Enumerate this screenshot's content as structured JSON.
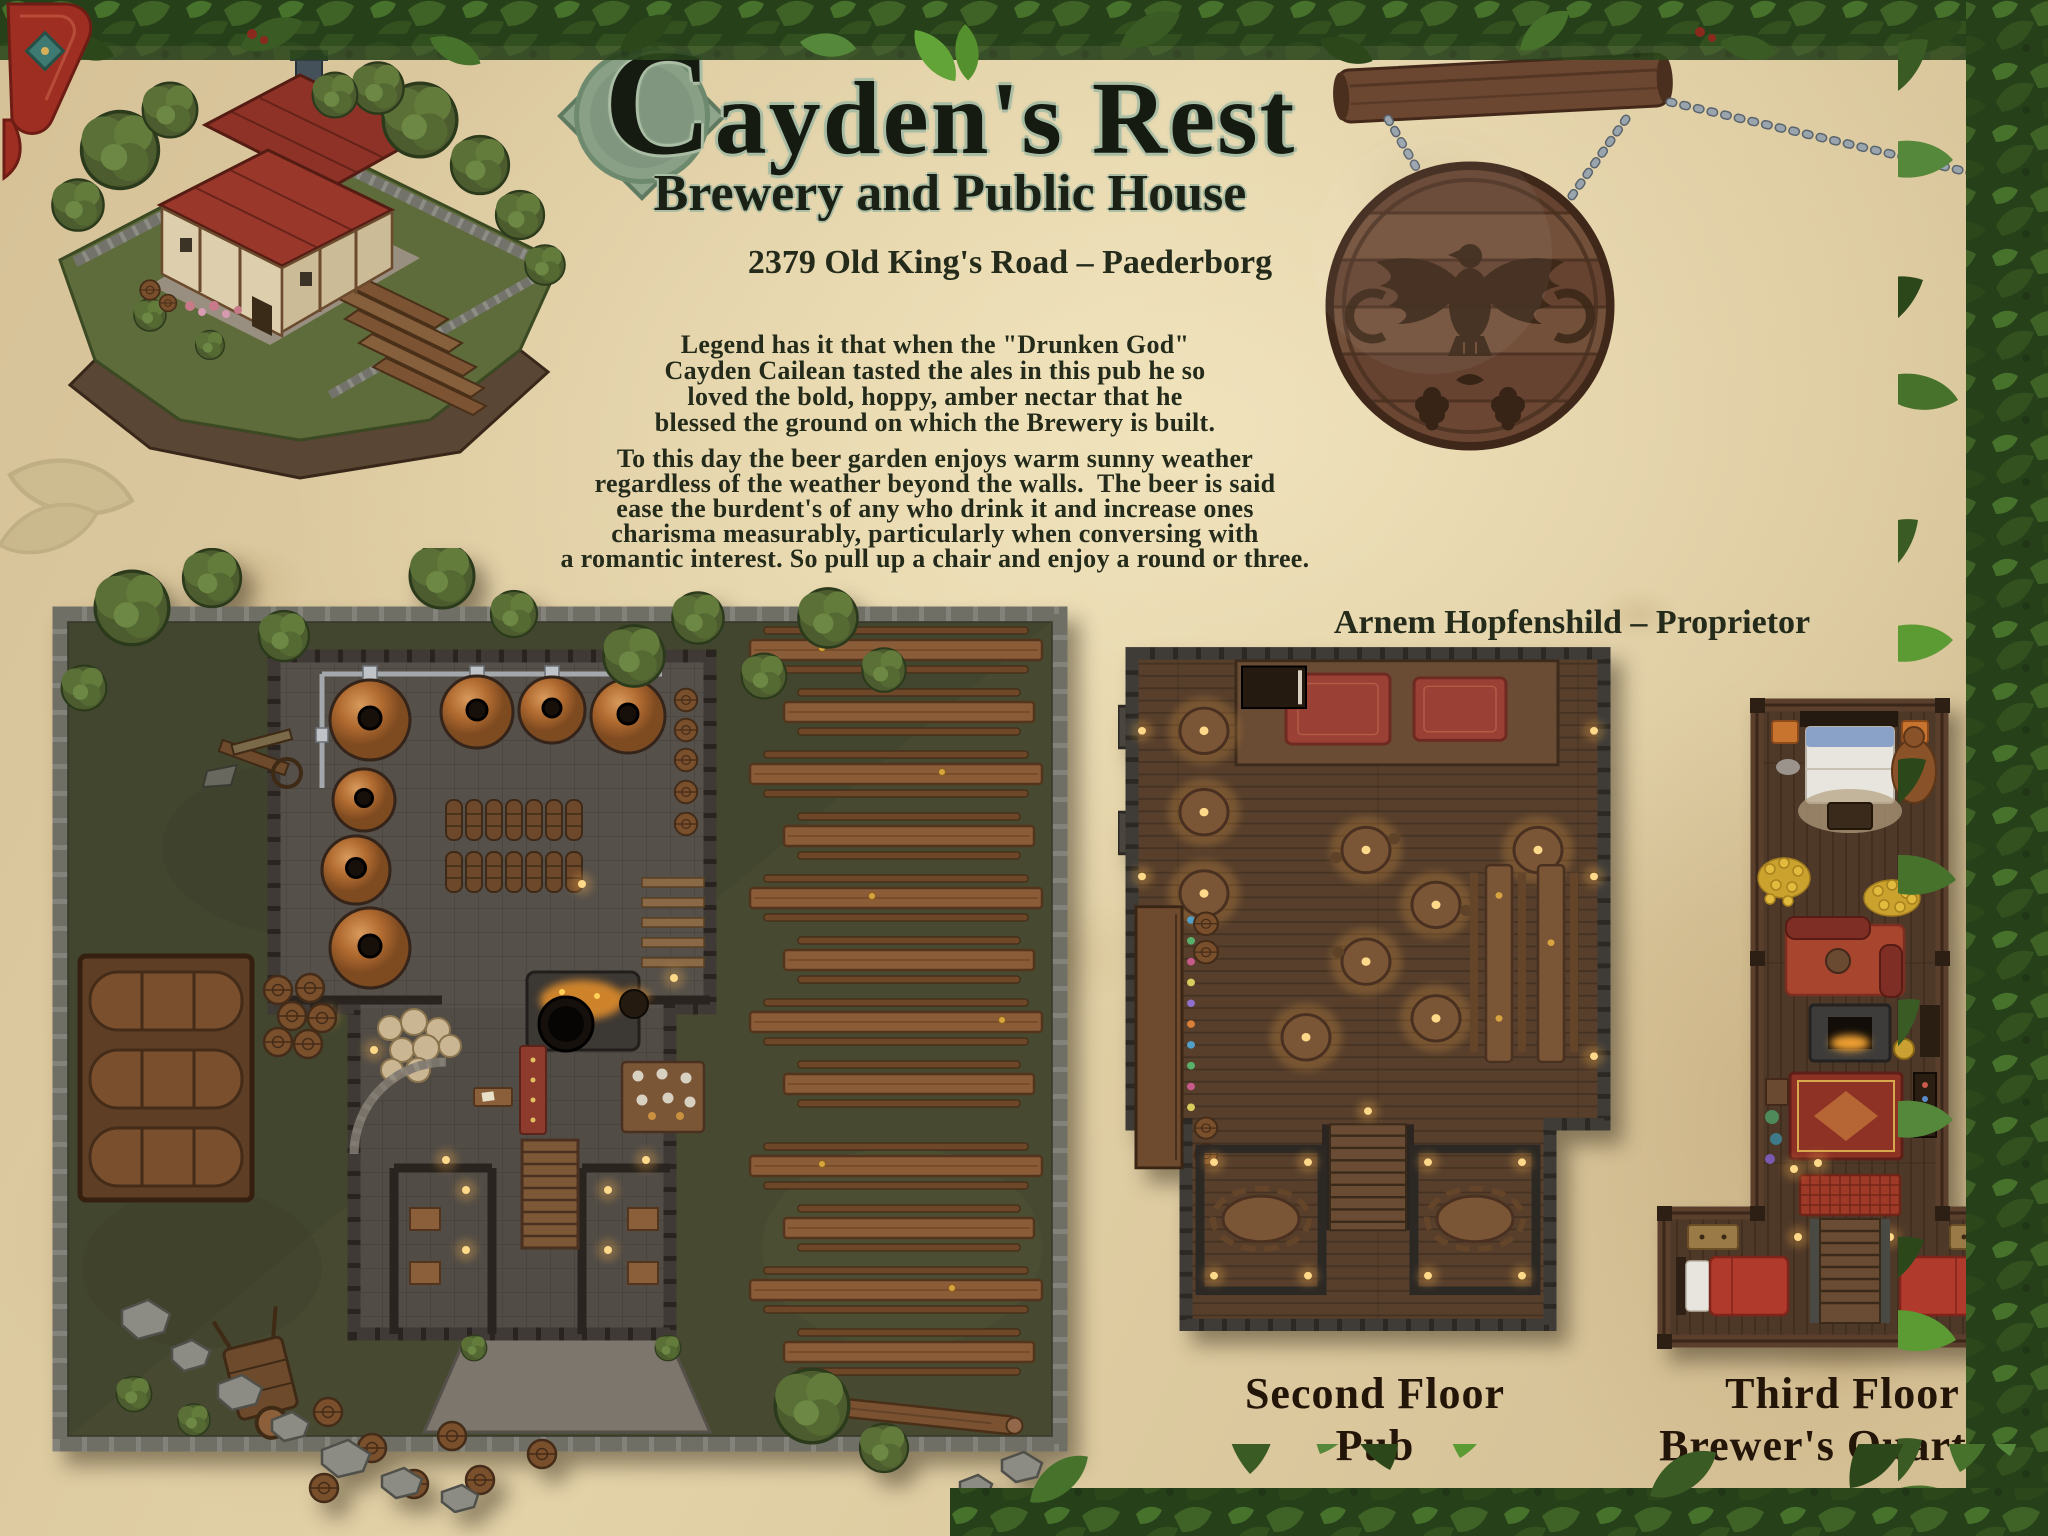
{
  "header": {
    "title": "Cayden's Rest",
    "subtitle": "Brewery and Public House",
    "address": "2379 Old King's Road – Paederborg"
  },
  "story": {
    "legend_lines": [
      "Legend has it that when the \"Drunken God\"",
      "Cayden Cailean tasted the ales in this pub he so",
      "loved the bold, hoppy, amber nectar that he",
      "blessed the ground on which the Brewery is built."
    ],
    "garden_lines": [
      "To this day the beer garden enjoys warm sunny weather",
      "regardless of the weather beyond the walls.  The beer is said",
      "ease the burdent's of any who drink it and increase ones",
      "charisma measurably, particularly when conversing with",
      "a romantic interest. So pull up a chair and enjoy a round or three."
    ],
    "proprietor": "Arnem Hopfenshild – Proprietor"
  },
  "captions": {
    "second_floor": [
      "Second Floor",
      "Pub"
    ],
    "third_floor": [
      "Third Floor",
      "Brewer's Quarters"
    ]
  },
  "icons": {
    "sign_emblem": "heraldic-eagle-with-hops",
    "borders": "leaf-vine-garland",
    "hanging": "chain-links-and-wood-beam",
    "map_features": [
      "trees",
      "barrels",
      "copper-kettles",
      "furnace-cauldron",
      "beer-garden-tables",
      "benches",
      "stairs",
      "beds",
      "rugs",
      "fireplace",
      "gold-hoard",
      "rocks",
      "cart",
      "bar-counter",
      "stage"
    ]
  },
  "colors": {
    "parchment": "#decaa2",
    "ink": "#242b1b",
    "title_outline": "#a9bca4",
    "leaf_green_dark": "#2f4a1d",
    "leaf_green_light": "#55883a",
    "sign_wood": "#6e4a33",
    "emblem_brown": "#3a2616",
    "map_grass": "#474a31",
    "stone_wall": "#83837b",
    "copper_kettle": "#b06a30",
    "table_wood": "#8a5c38",
    "pub_floor": "#573f2c",
    "lamp_glow": "#f5b04c",
    "rug_red": "#a03a28",
    "roof_red": "#9a372b"
  }
}
